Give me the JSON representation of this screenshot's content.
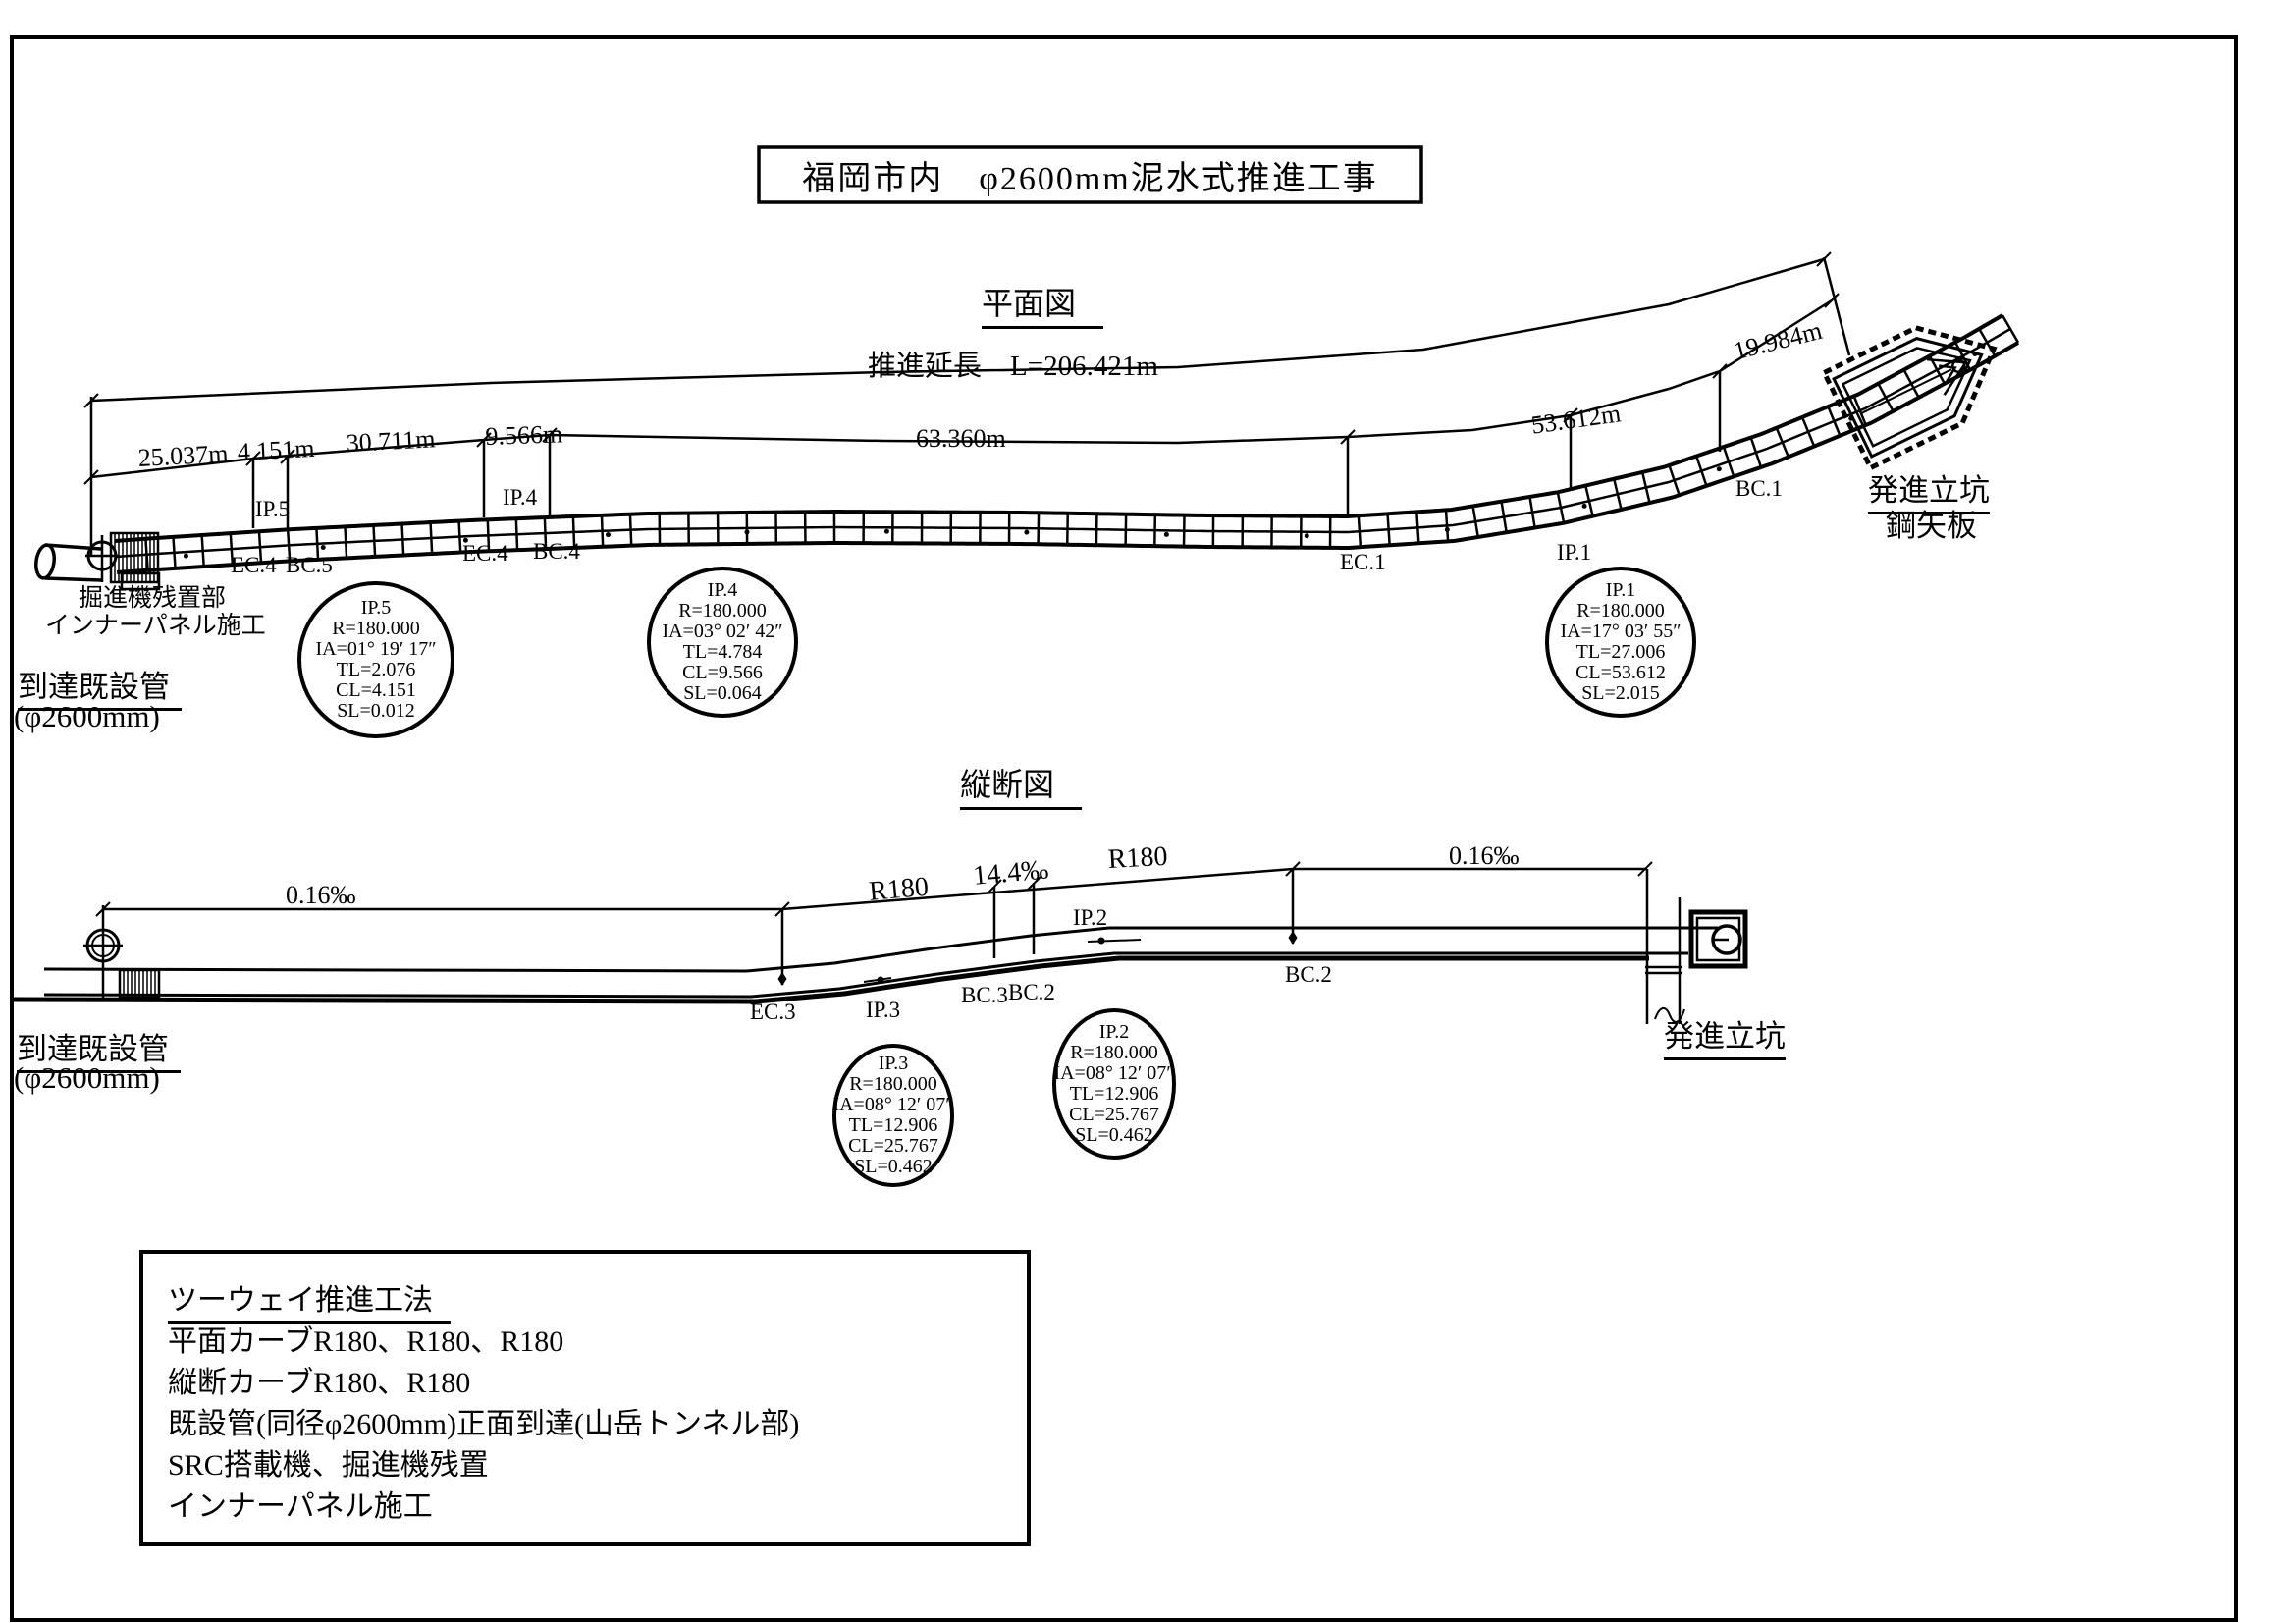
{
  "title": "福岡市内　φ2600mm泥水式推進工事",
  "plan": {
    "heading": "平面図",
    "total_length": "推進延長　L=206.421m",
    "dims": [
      "25.037m",
      "4.151m",
      "30.711m",
      "9.566m",
      "63.360m",
      "53.612m",
      "19.984m"
    ],
    "points": {
      "ip5": "IP.5",
      "ip4": "IP.4",
      "ec4a": "EC.4",
      "bc5": "BC.5",
      "ec4b": "EC.4",
      "bc4": "BC.4",
      "ec1": "EC.1",
      "ip1": "IP.1",
      "bc1": "BC.1"
    },
    "ip_circles": [
      {
        "lines": [
          "IP.5",
          "R=180.000",
          "IA=01° 19′ 17″",
          "TL=2.076",
          "CL=4.151",
          "SL=0.012"
        ]
      },
      {
        "lines": [
          "IP.4",
          "R=180.000",
          "IA=03° 02′ 42″",
          "TL=4.784",
          "CL=9.566",
          "SL=0.064"
        ]
      },
      {
        "lines": [
          "IP.1",
          "R=180.000",
          "IA=17° 03′ 55″",
          "TL=27.006",
          "CL=53.612",
          "SL=2.015"
        ]
      }
    ],
    "machine_note_line1": "掘進機残置部",
    "machine_note_line2": "インナーパネル施工",
    "arrival_title": "到達既設管",
    "arrival_sub": "(φ2600mm)",
    "launch_shaft_title": "発進立坑",
    "launch_shaft_sub": "鋼矢板"
  },
  "profile": {
    "heading": "縦断図",
    "grade_left": "0.16‰",
    "grade_mid": "14.4‰",
    "grade_right": "0.16‰",
    "radius_left": "R180",
    "radius_right": "R180",
    "points": {
      "ec3": "EC.3",
      "ip3": "IP.3",
      "bc3": "BC.3",
      "bc2a": "BC.2",
      "ip2": "IP.2",
      "bc2b": "BC.2"
    },
    "ip_circles": [
      {
        "lines": [
          "IP.3",
          "R=180.000",
          "IA=08° 12′ 07″",
          "TL=12.906",
          "CL=25.767",
          "SL=0.462"
        ]
      },
      {
        "lines": [
          "IP.2",
          "R=180.000",
          "IA=08° 12′ 07″",
          "TL=12.906",
          "CL=25.767",
          "SL=0.462"
        ]
      }
    ],
    "arrival_title": "到達既設管",
    "arrival_sub": "(φ2600mm)",
    "launch_shaft_title": "発進立坑"
  },
  "notes": {
    "title": "ツーウェイ推進工法",
    "lines": [
      "平面カーブR180、R180、R180",
      "縦断カーブR180、R180",
      "既設管(同径φ2600mm)正面到達(山岳トンネル部)",
      "SRC搭載機、掘進機残置",
      "インナーパネル施工"
    ]
  }
}
